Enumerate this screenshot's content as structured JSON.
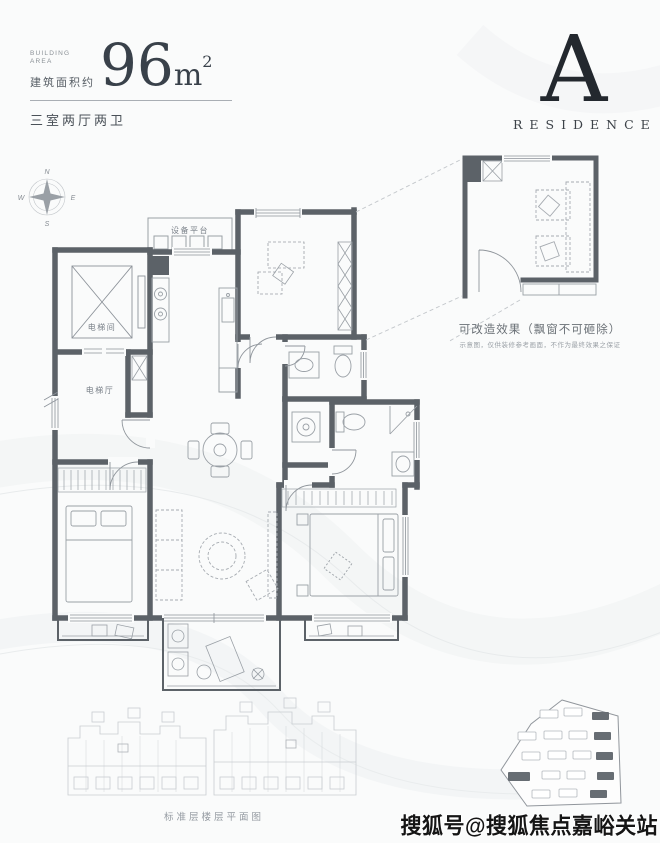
{
  "header": {
    "building_area_en_line1": "BUILDING",
    "building_area_en_line2": "AREA",
    "building_area_cn": "建筑面积约",
    "area_number": "96",
    "area_unit": "m",
    "area_superscript": "2",
    "layout": "三室两厅两卫"
  },
  "brand": {
    "letter": "A",
    "word": "RESIDENCE"
  },
  "compass": {
    "north": "N",
    "south": "S",
    "east": "E",
    "west": "W"
  },
  "plan_labels": {
    "equipment_platform": "设备平台",
    "elevator_shaft": "电梯间",
    "elevator_hall": "电梯厅"
  },
  "inset": {
    "caption": "可改造效果（飘窗不可砸除）",
    "note": "示意图，仅供装修参考画面，不作为最终效果之保证"
  },
  "footer": {
    "floor_caption": "标准层楼层平面图",
    "watermark": "搜狐号@搜狐焦点嘉峪关站"
  },
  "colors": {
    "wall": "#5c6268",
    "thin_line": "#9aa0a6",
    "text_dark": "#3a414a"
  }
}
